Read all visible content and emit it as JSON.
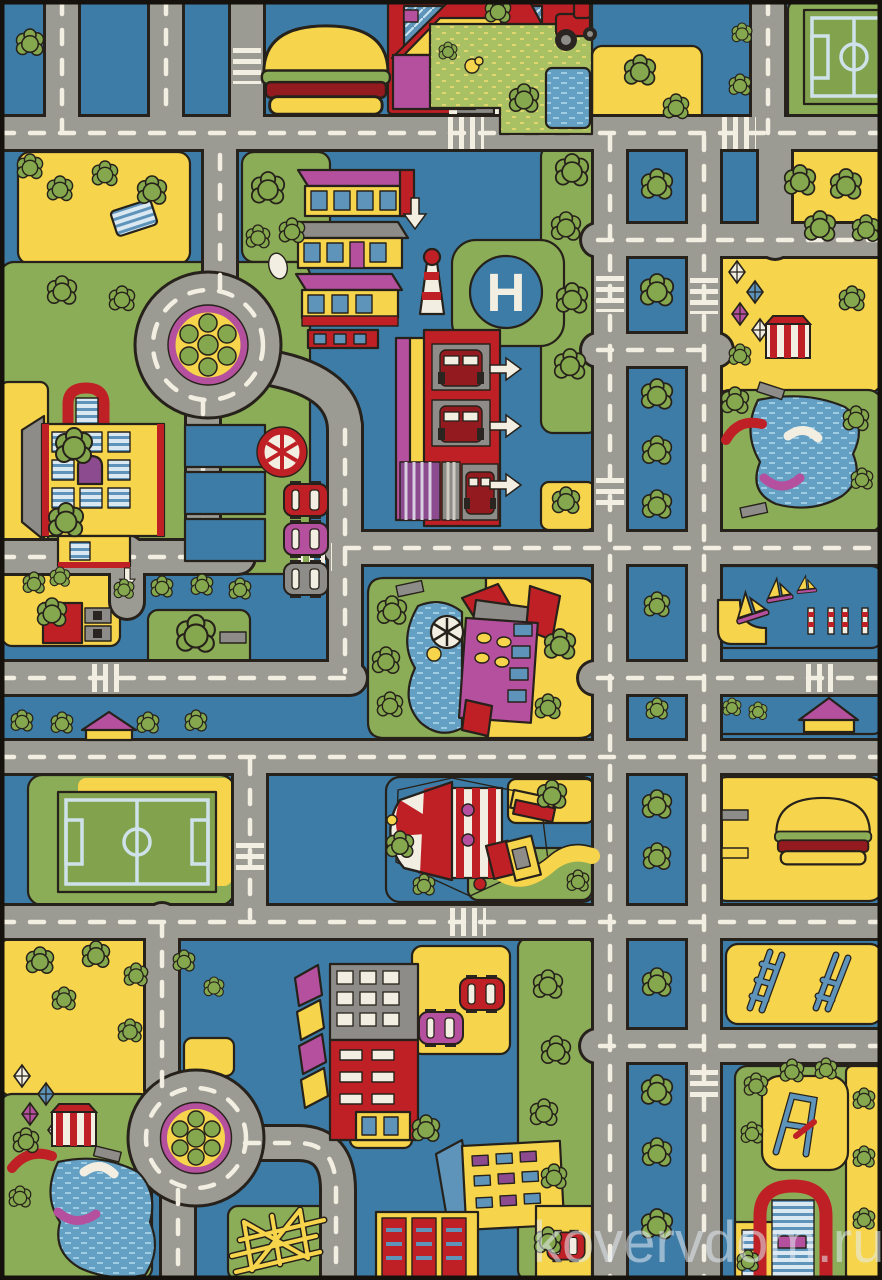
{
  "image": {
    "alt": "Children's play rug with a city road-map pattern: gray roads with dashed lines, roundabouts, helipad, fire station, soccer fields, circus tent, playgrounds, houses, parked cars and trees on a blue background",
    "width_px": 882,
    "height_px": 1280
  },
  "watermark": {
    "text": "kovervdom.ru"
  },
  "helipad": {
    "letter": "H"
  },
  "landmarks": [
    "hamburger kiosk",
    "family house with garden and pond",
    "soccer field top right",
    "roundabout with flower island",
    "school building with red arch",
    "shop houses",
    "lighthouse",
    "helipad",
    "fire station with trucks and white arrows",
    "parked cars",
    "gas station",
    "left soccer field",
    "circus big top",
    "ticket booth",
    "playground pond with slides",
    "sailing boats",
    "red apartment building",
    "parking lot with cars",
    "climbing frame",
    "second roundabout",
    "bottom-right school arch"
  ],
  "palette": {
    "bgBlue": "#3d7ca6",
    "roadGray": "#9b9a93",
    "lineWhite": "#f2efe2",
    "yellow": "#f6d44b",
    "grass": "#8cad57",
    "tree": "#85a84e",
    "red": "#bf2026",
    "darkRed": "#931a1f",
    "magenta": "#b4509d",
    "purple": "#8c4a8f",
    "window": "#5e93ba",
    "glassLight": "#cfe6f2",
    "pond": "#63a0c4",
    "white": "#f2efe2",
    "gray": "#8d8c88",
    "outline": "#26211a",
    "pitchLine": "#cfe2ea",
    "speckle": "#a9c163",
    "speckleDash": "#dfd66e",
    "watermark": "rgba(228,235,242,0.55)"
  }
}
